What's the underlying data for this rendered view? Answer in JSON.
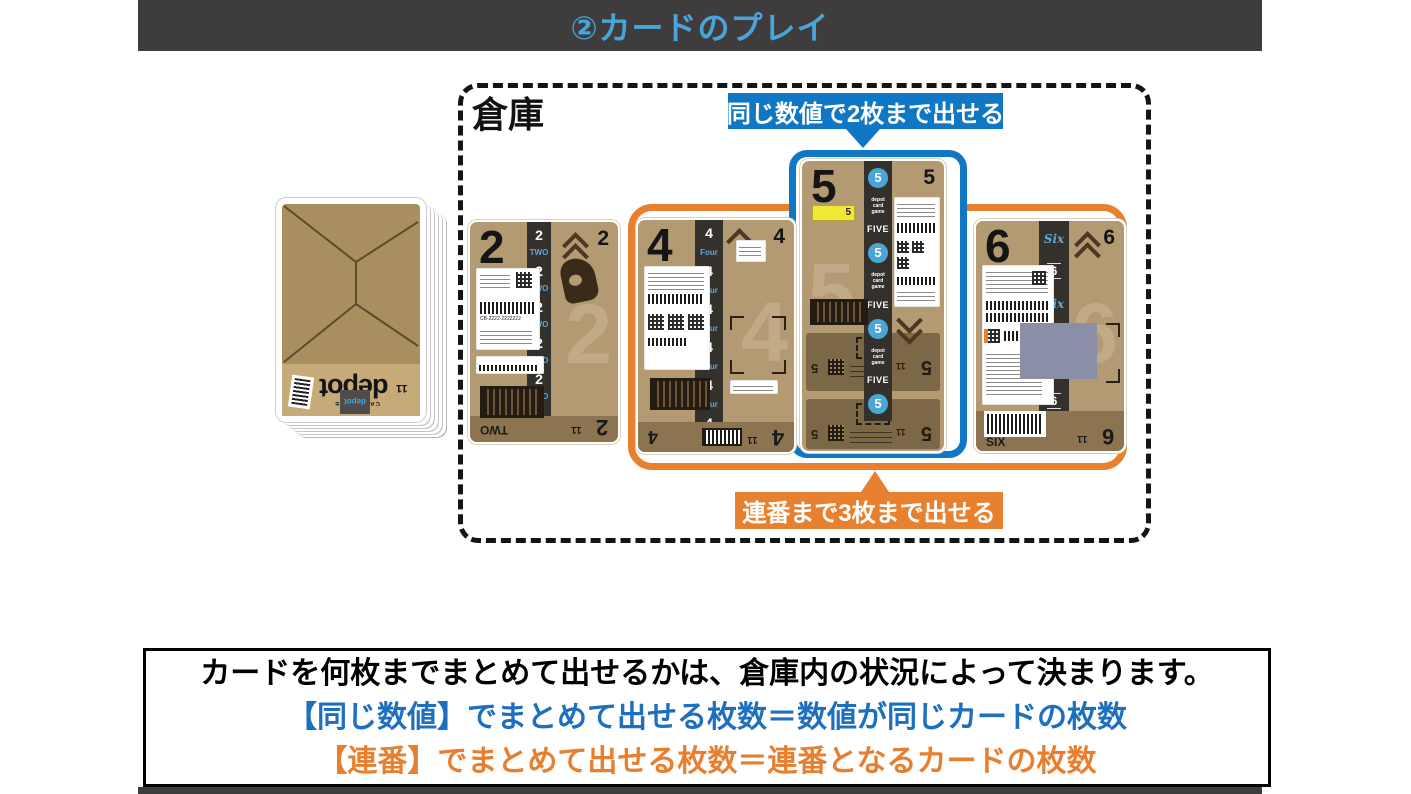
{
  "colors": {
    "bar_bg": "#3e3c3d",
    "title_blue": "#4aa4da",
    "blue": "#1077c4",
    "orange": "#e8812f",
    "text_blue": "#1d6fc0",
    "text_orange": "#e87f2f",
    "card_tan": "#b49a72",
    "band_brown": "#8c7450",
    "band_brown2": "#7c6847",
    "strip_dark": "#34312d",
    "strip_blue": "#5fa8d8",
    "circle_blue": "#4aa6d4",
    "deck_tan": "#a98f60",
    "deck_band": "#c6ab79",
    "gray_patch": "#8a8ea7",
    "yellow": "#f2e838"
  },
  "header": {
    "title": "②カードのプレイ"
  },
  "warehouse": {
    "label": "倉庫",
    "callout_same": "同じ数値で2枚まで出せる",
    "callout_run": "連番まで3枚まで出せる"
  },
  "deck": {
    "logo": "depot",
    "tagline": "CARD GAME",
    "tally": "11"
  },
  "cards": [
    {
      "number": "2",
      "corner": "2",
      "word": "TWO",
      "band_left": "TWO",
      "tally": "11",
      "label_code": "CB-2222-2222222",
      "strip": [
        "2",
        "TWO",
        "2",
        "TWO",
        "2",
        "TWO",
        "2",
        "TWO",
        "2",
        "TWO",
        "2",
        "TWO"
      ]
    },
    {
      "number": "4",
      "corner": "4",
      "word": "Four",
      "band_left": "4",
      "tally": "11",
      "strip": [
        "4",
        "Four",
        "4",
        "Four",
        "4",
        "Four",
        "4",
        "Four",
        "4",
        "Four",
        "4",
        "Four"
      ]
    },
    {
      "number": "5",
      "corner": "5",
      "word": "FIVE",
      "tag": "5",
      "tally": "11",
      "strip": [
        "5",
        "depot card game",
        "FIVE",
        "5",
        "depot card game",
        "FIVE",
        "5",
        "depot card game",
        "FIVE",
        "5"
      ]
    },
    {
      "number": "6",
      "corner": "6",
      "word": "Six",
      "band_left": "SIX",
      "tally": "11",
      "strip": [
        "Six",
        "6",
        "Six",
        "6",
        "Six",
        "6",
        "Six"
      ]
    }
  ],
  "footer": {
    "line1": "カードを何枚までまとめて出せるかは、倉庫内の状況によって決まります。",
    "line2": "【同じ数値】でまとめて出せる枚数＝数値が同じカードの枚数",
    "line3": "【連番】でまとめて出せる枚数＝連番となるカードの枚数"
  }
}
